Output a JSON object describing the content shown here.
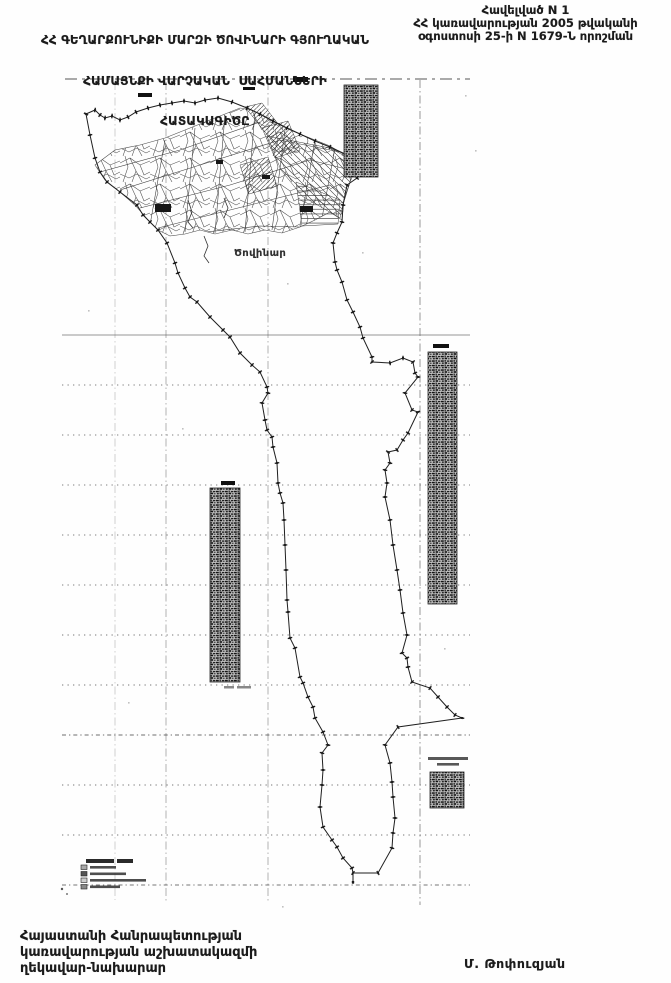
{
  "header": {
    "annex": {
      "line1": "Հավելված N 1",
      "line2": "ՀՀ կառավարության 2005 թվականի",
      "line3": "օգոստոսի 25-ի N 1679-Ն որոշման"
    },
    "title": {
      "line1": "ՀՀ ԳԵՂԱՐՔՈՒՆԻՔԻ ՄԱՐԶԻ ԾՈՎԻՆԱՐԻ ԳՅՈՒՂԱԿԱՆ",
      "line2": "ՀԱՄԱՅՆՔԻ ՎԱՐՉԱԿԱՆ  ՍԱՀՄԱՆՆԵՐԻ",
      "line3": "ՀԱՏԱԿԱԳԻԾԸ"
    }
  },
  "map": {
    "settlement_label": "Ծովինար"
  },
  "footer": {
    "office_line1": "Հայաստանի Հանրապետության",
    "office_line2": "կառավարության աշխատակազմի",
    "office_line3": "ղեկավար-նախարար",
    "signature": "Մ. Թոփուզյան"
  },
  "colors": {
    "paper": "#fefefe",
    "ink": "#1b1b1b",
    "boundary_line": "#1f1f1f",
    "grid_line": "#6f6f6f",
    "table_fill": "#c8c8c8"
  }
}
